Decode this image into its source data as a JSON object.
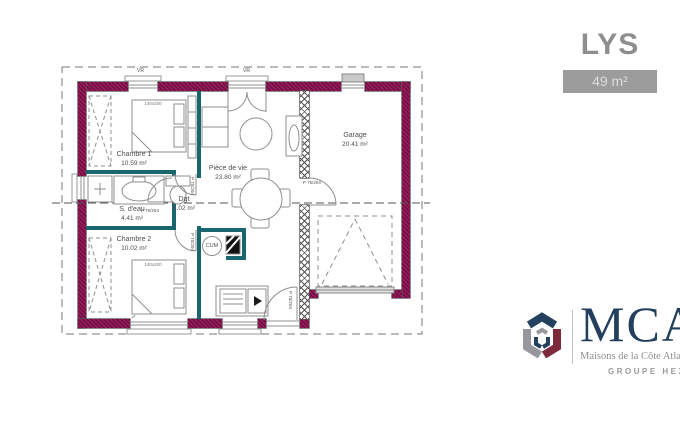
{
  "header": {
    "plan_name": "LYS",
    "area_badge": "49 m²"
  },
  "plan": {
    "rooms": [
      {
        "name": "Chambre 1",
        "area": "10.59 m²"
      },
      {
        "name": "S. d'eau",
        "area": "4.41 m²"
      },
      {
        "name": "Dgt",
        "area": "1.02 m²"
      },
      {
        "name": "Chambre 2",
        "area": "10.02 m²"
      },
      {
        "name": "Pièce de vie",
        "area": "23.80 m²"
      },
      {
        "name": "Garage",
        "area": "20.41 m²"
      }
    ],
    "annotations": {
      "bed_size": "140x200",
      "water_heater": "CUM",
      "door_label": "P 75/204",
      "shutter_label": "VR"
    },
    "colors": {
      "exterior_wall": "#96195a",
      "partition": "#1a666e",
      "linework": "#8f8f8f"
    }
  },
  "branding": {
    "logo_text": "MCA",
    "logo_subtitle": "Maisons de la Côte Atlantique",
    "group_label": "GROUPE HEXAOM",
    "logo_colors": {
      "navy": "#24415f",
      "gray": "#97979d",
      "maroon": "#7d2b3c"
    }
  }
}
